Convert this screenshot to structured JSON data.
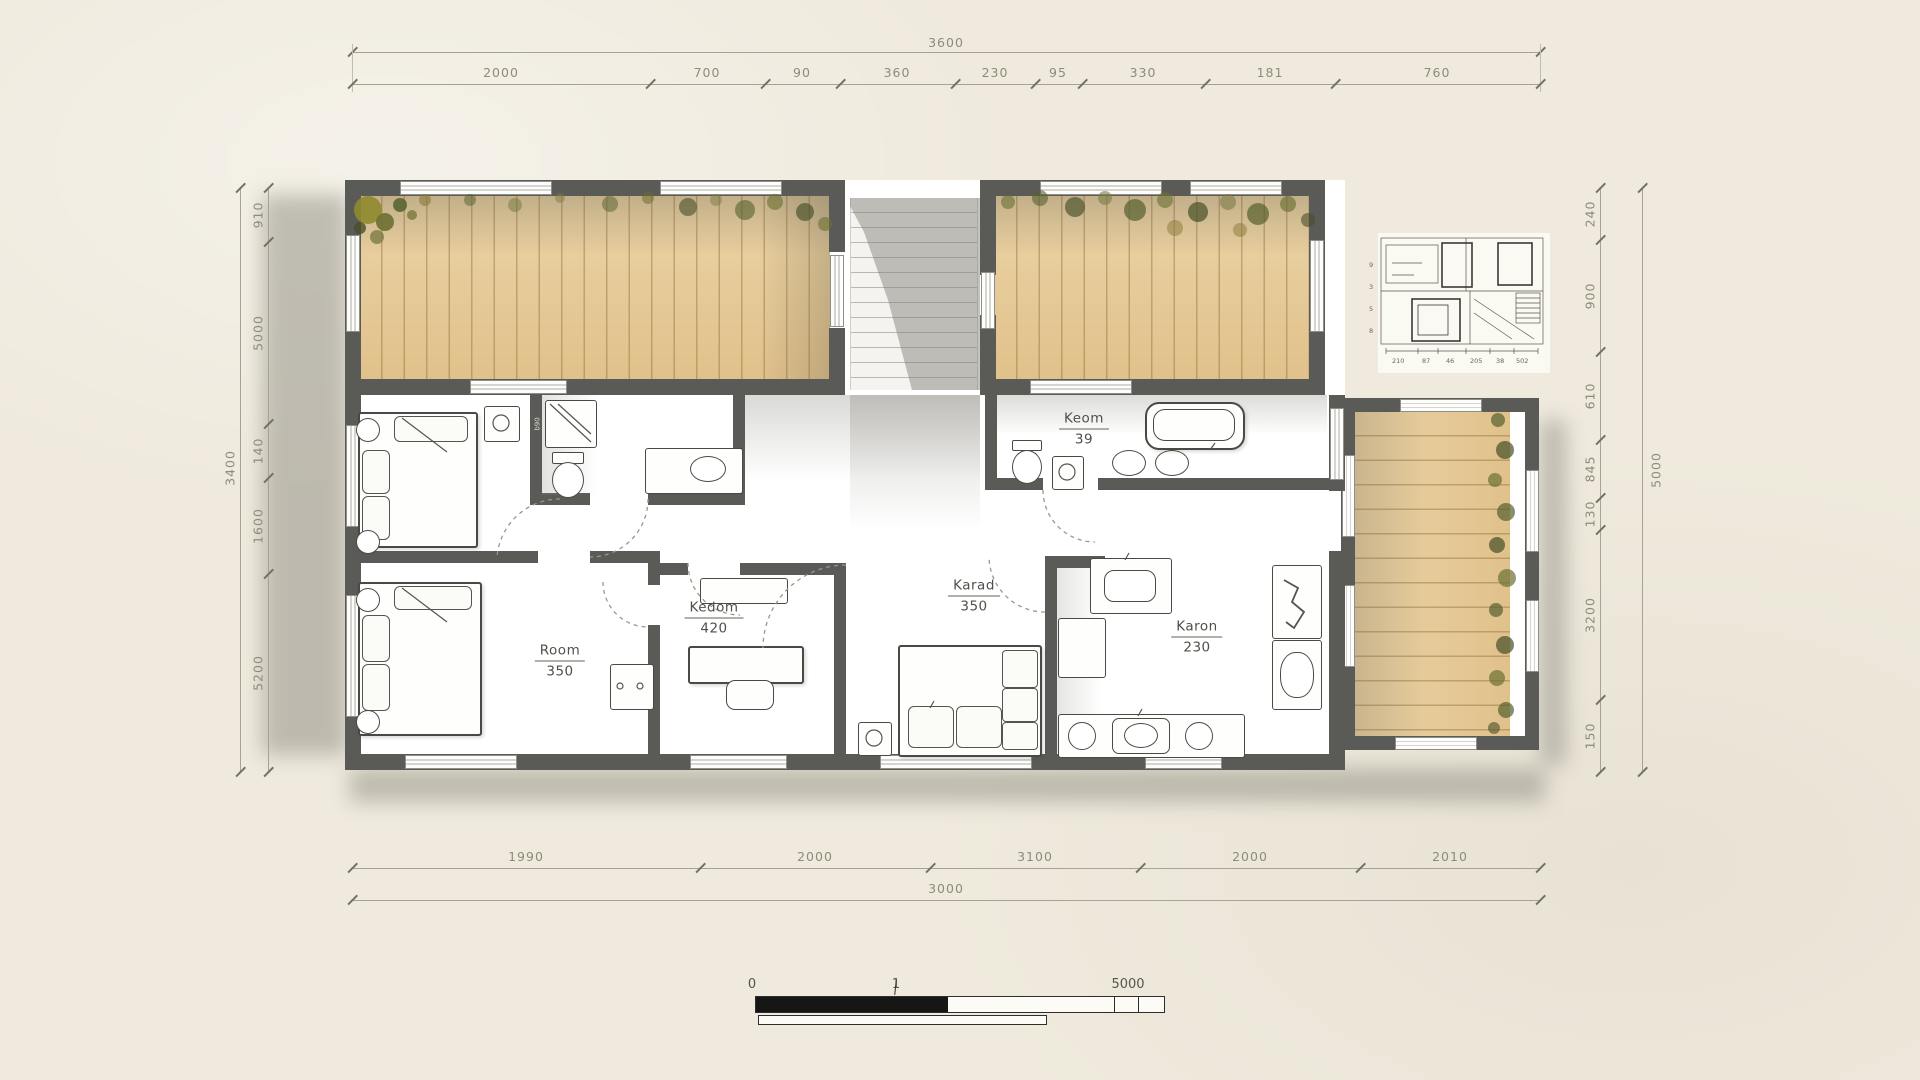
{
  "drawing": {
    "rooms": [
      {
        "name": "Room",
        "area": "350"
      },
      {
        "name": "Kedom",
        "area": "420"
      },
      {
        "name": "Karad",
        "area": "350"
      },
      {
        "name": "Karon",
        "area": "230"
      },
      {
        "name": "Keom",
        "area": "39"
      }
    ],
    "wall_tag": "b90"
  },
  "dimensions": {
    "top": {
      "overall": "3600",
      "segments": [
        "2000",
        "700",
        "90",
        "360",
        "230",
        "95",
        "330",
        "181",
        "760"
      ]
    },
    "bottom": {
      "overall": "3000",
      "segments": [
        "1990",
        "2000",
        "3100",
        "2000",
        "2010"
      ]
    },
    "left": {
      "overall": "3400",
      "segments": [
        "910",
        "5000",
        "140",
        "1600",
        "5200"
      ]
    },
    "right": {
      "overall": "5000",
      "segments": [
        "240",
        "900",
        "610",
        "845",
        "130",
        "3200",
        "150"
      ]
    }
  },
  "scale_bar": {
    "start": "0",
    "mid": "1",
    "end": "5000"
  },
  "inset": {
    "bottom_numbers": [
      "210",
      "87",
      "46",
      "205",
      "38",
      "502"
    ],
    "left_numbers": [
      "9",
      "3",
      "5",
      "8"
    ]
  },
  "colors": {
    "paper": "#efeadd",
    "wall": "#5a5a57",
    "deck": "#e5c795",
    "shadow": "#8d8a80",
    "dim_line": "#a6a396",
    "dim_text": "#8e8b7b",
    "greenery": "#6b7035"
  }
}
